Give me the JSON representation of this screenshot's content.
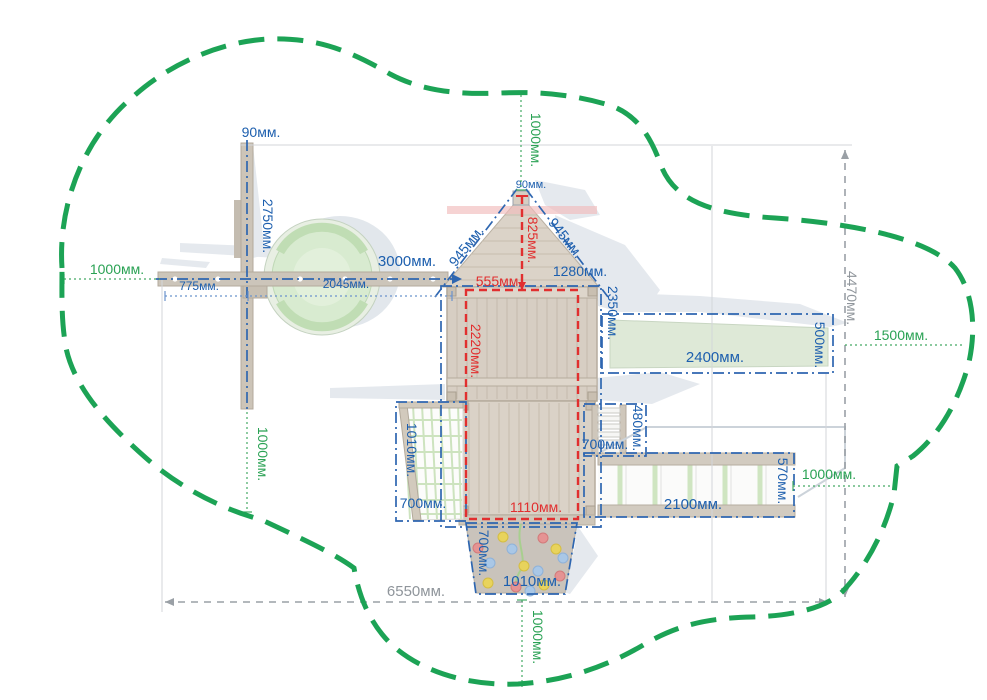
{
  "colors": {
    "boundary_green": "#1ca355",
    "dim_blue": "#1d5fae",
    "dim_red": "#e12f2f",
    "dim_green": "#2aa254",
    "dim_gray": "#8f959b",
    "wood_light": "#d6cdc2",
    "slide_green": "#dee9d7",
    "net_green": "#cde3bf"
  },
  "dims": {
    "swing": {
      "pole_width": "90мм.",
      "pole_height": "2750мм.",
      "beam_length": "3000мм.",
      "offset_left": "775мм.",
      "beam_inner": "2045мм."
    },
    "tower": {
      "finial_width": "90мм.",
      "roof_edge_left": "945мм.",
      "roof_edge_right": "945мм.",
      "roof_height": "825мм.",
      "top_opening": "555мм.",
      "upper_width": "1280мм.",
      "side_height": "2350мм.",
      "frame_height": "2220мм.",
      "frame_width": "1110мм."
    },
    "slide": {
      "length": "2400мм.",
      "width": "500мм."
    },
    "steps": {
      "depth": "480мм.",
      "width": "700мм."
    },
    "monkey_bars": {
      "length": "2100мм.",
      "width": "570мм."
    },
    "net": {
      "height": "1010мм.",
      "width": "700мм."
    },
    "wall": {
      "height": "700мм.",
      "width": "1010мм."
    },
    "zone": {
      "width": "6550мм.",
      "height": "4470мм."
    },
    "clearance": {
      "top": "1000мм.",
      "left": "1000мм.",
      "pole_bottom": "1000мм.",
      "right": "1500мм.",
      "bars_right": "1000мм.",
      "bottom": "1000мм."
    }
  }
}
